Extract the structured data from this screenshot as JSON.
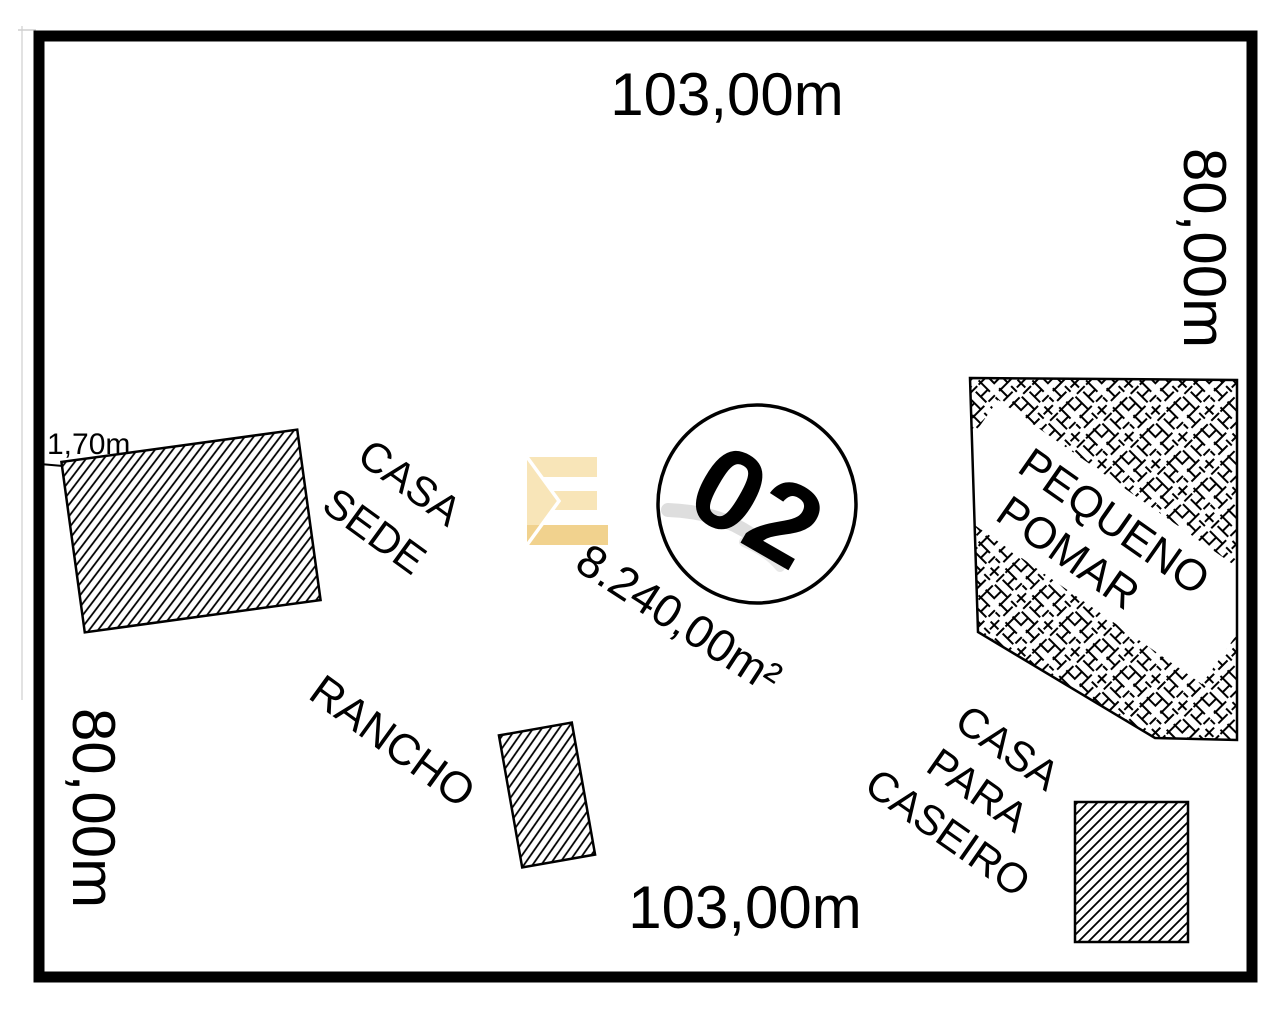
{
  "plan": {
    "lot_number": "02",
    "area": "8.240,00m²",
    "dim_top": "103,00m",
    "dim_bottom": "103,00m",
    "dim_left": "80,00m",
    "dim_right": "80,00m",
    "dim_offset": "1,70m",
    "buildings": {
      "casa_sede": {
        "line1": "CASA",
        "line2": "SEDE"
      },
      "rancho": {
        "label": "RANCHO"
      },
      "pomar": {
        "line1": "PEQUENO",
        "line2": "POMAR"
      },
      "caseiro": {
        "line1": "CASA",
        "line2": "PARA",
        "line3": "CASEIRO"
      }
    },
    "colors": {
      "ink": "#000000",
      "paper": "#ffffff",
      "watermark_cream": "#f8e5b8",
      "watermark_gold": "#f1d28e"
    }
  }
}
